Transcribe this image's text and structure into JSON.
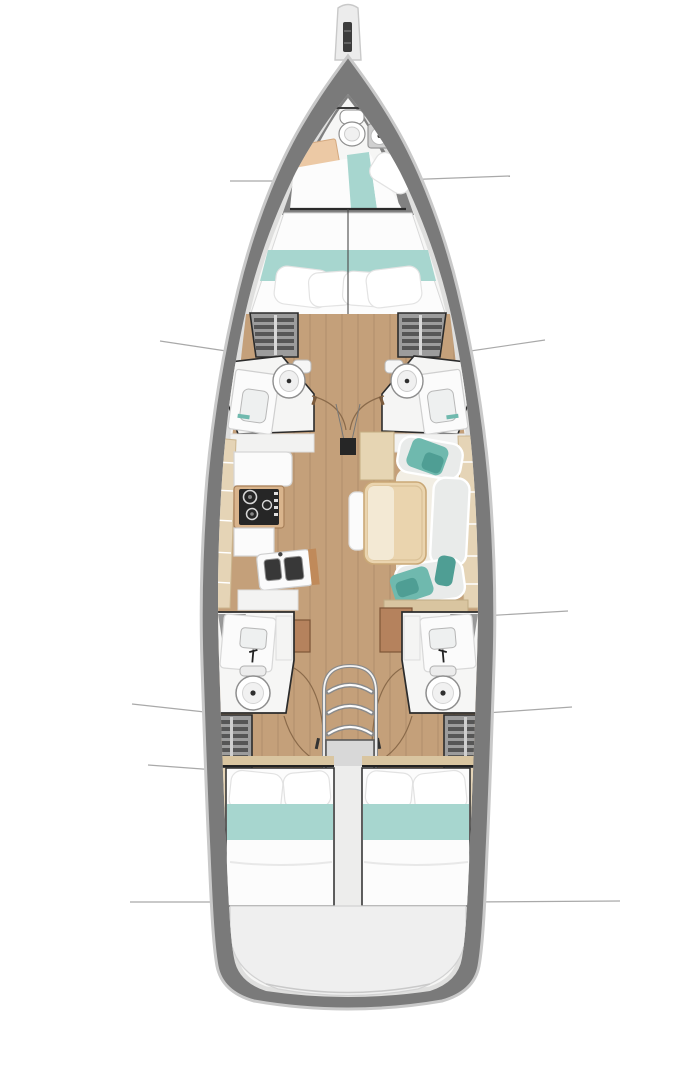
{
  "image": {
    "width": 682,
    "height": 1080,
    "alt": "Sailing yacht interior deck layout plan, top view"
  },
  "palette": {
    "canvas": "#ffffff",
    "hull_band": "#7a7a7a",
    "hull_rim": "#c9c9c9",
    "interior": "#f6f6f5",
    "wood_floor": "#c4a07a",
    "beige_trim": "#e5d4b6",
    "sill_tan": "#d9c5a0",
    "teal_fabric": "#a7d6cf",
    "teal_mid": "#6fb9ae",
    "teal_deep": "#4f9e94",
    "peach": "#ecc9a5",
    "table_wood": "#ead4ae",
    "table_leaf": "#f3e9d4",
    "cabinet_brown": "#b5825d",
    "locker_base": "#9c9c9c",
    "locker_slat": "#565656",
    "fixture_white": "#fbfbfb",
    "fixture_gray": "#d8d8d8",
    "cushion_gray": "#e9ebea",
    "stove_black": "#262626",
    "outline": "#2b2b2b",
    "wall_gray": "#8e8e8e",
    "door_arc": "#8a6a4a",
    "section_line": "#a9a9a9",
    "stern_platform": "#efefef",
    "stairs_gray": "#d8d8d8",
    "mattress": "#fcfcfc",
    "mast_black": "#262626"
  },
  "features": {
    "bowsprit": "Bowsprit with anchor roller",
    "forward_head": "Bow head with toilet, shower tray and vanity",
    "forward_berth": "Bow berth with teal runner and pillow",
    "owner_cabin": "Forward owner cabin double berth with teal blanket and four pillows",
    "forward_wardrobes": "Port and starboard slatted wardrobes",
    "forward_heads": "Port and starboard forward heads with toilet and basin",
    "mast": "Mast foot on centerline",
    "galley": "Port galley with worktops, two-burner stove and double sink",
    "saloon": "Starboard U-shaped settee with teal throws, saloon table and chaise bench",
    "aft_heads": "Port and starboard aft heads with basin and toilet",
    "aft_wardrobes": "Port and starboard aft slatted wardrobes",
    "companionway": "Companionway stairs with four arched treads and landing",
    "aft_cabins": "Twin aft double cabins with teal blankets",
    "swim_platform": "Stern swim platform",
    "section_lines": "Six hull section reference lines"
  }
}
